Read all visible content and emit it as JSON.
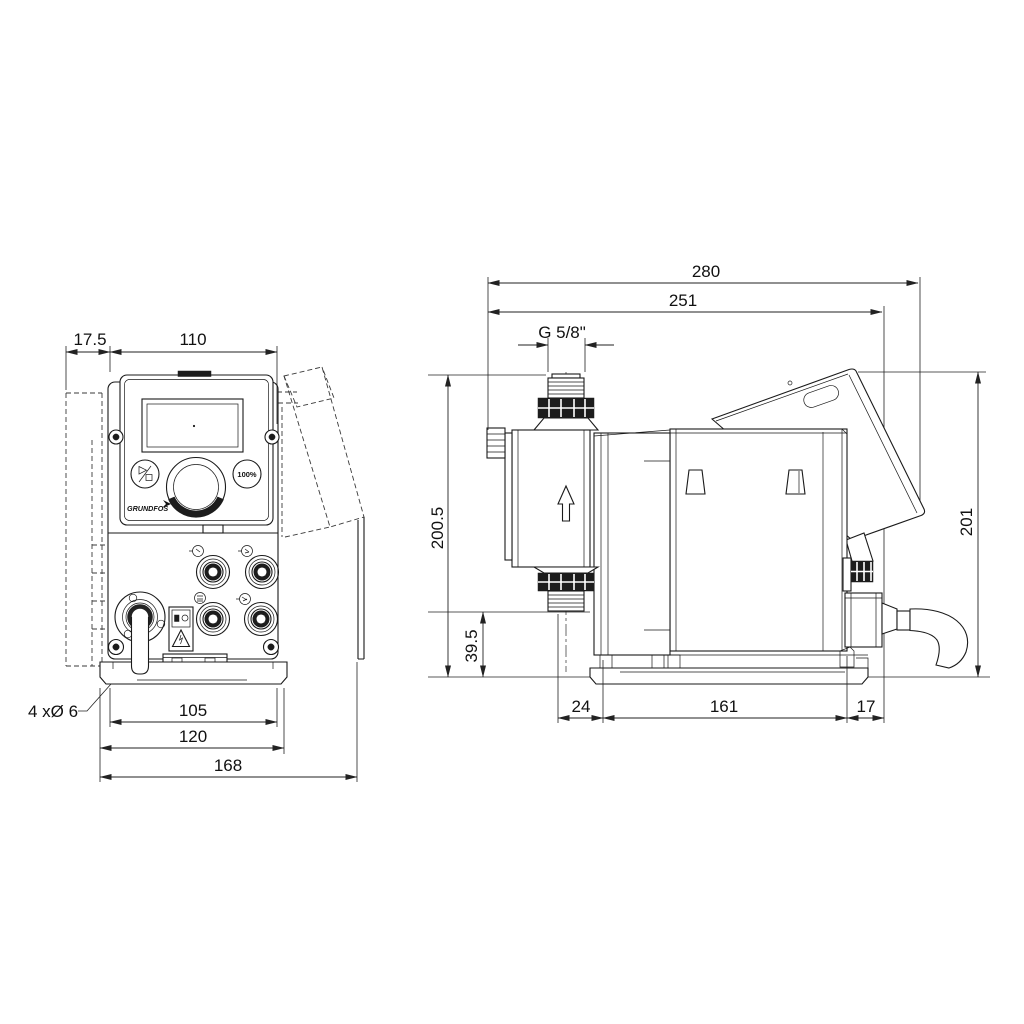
{
  "style": {
    "ink": "#1a1a1a",
    "dim_ink": "#222222",
    "background": "#ffffff"
  },
  "front": {
    "dim_wall_offset": "17.5",
    "dim_panel_width": "110",
    "dim_hole_spacing": "105",
    "dim_plate_width": "120",
    "dim_overall_width": "168",
    "mounting_holes_label": "4 xØ 6",
    "button_100_label": "100%",
    "brand_label": "GRUNDFOS"
  },
  "side": {
    "dim_overall_depth": "280",
    "dim_depth_to_cable_gland": "251",
    "thread_label": "G 5/8\"",
    "dim_overall_height": "200.5",
    "dim_suction_valve_height": "39.5",
    "dim_base_front_offset": "24",
    "dim_base_length": "161",
    "dim_base_rear_offset": "17",
    "dim_rear_height": "201"
  }
}
